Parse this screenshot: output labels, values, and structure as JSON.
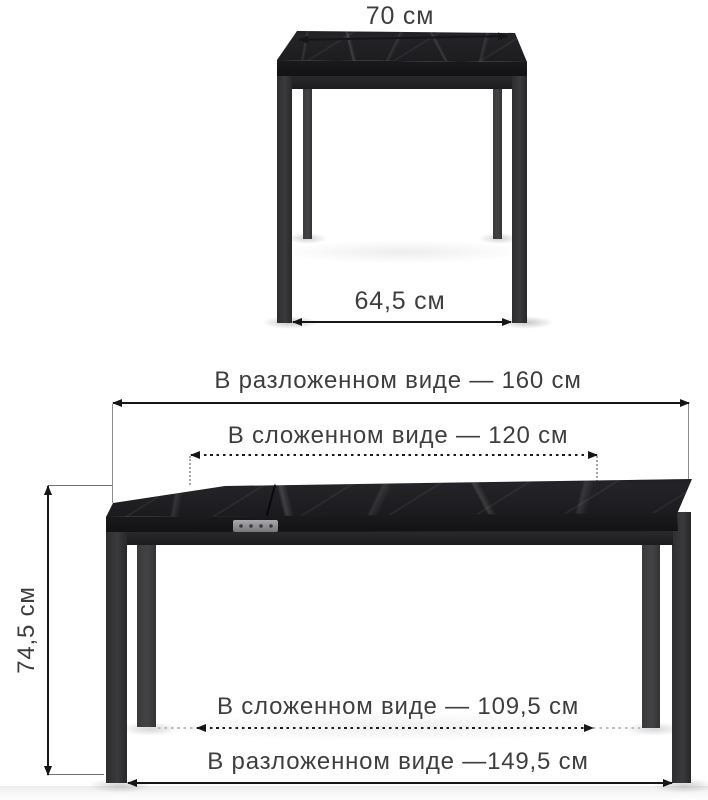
{
  "product_diagram": {
    "front_view": {
      "top_width": "70 см",
      "between_legs_width": "64,5 см"
    },
    "side_view": {
      "unfolded_length_top": "В разложенном виде — 160 см",
      "folded_length_top": "В сложенном виде — 120 см",
      "height": "74,5 см",
      "folded_length_legs": "В сложенном виде — 109,5 см",
      "unfolded_length_legs": "В разложенном виде —149,5 см"
    }
  },
  "colors": {
    "background": "#ffffff",
    "dimension_text": "#3e3e3e",
    "dimension_line": "#161616",
    "tabletop_marble": "#1f1f22",
    "table_leg": "#323234",
    "latch_metal": "#8f8f93"
  }
}
